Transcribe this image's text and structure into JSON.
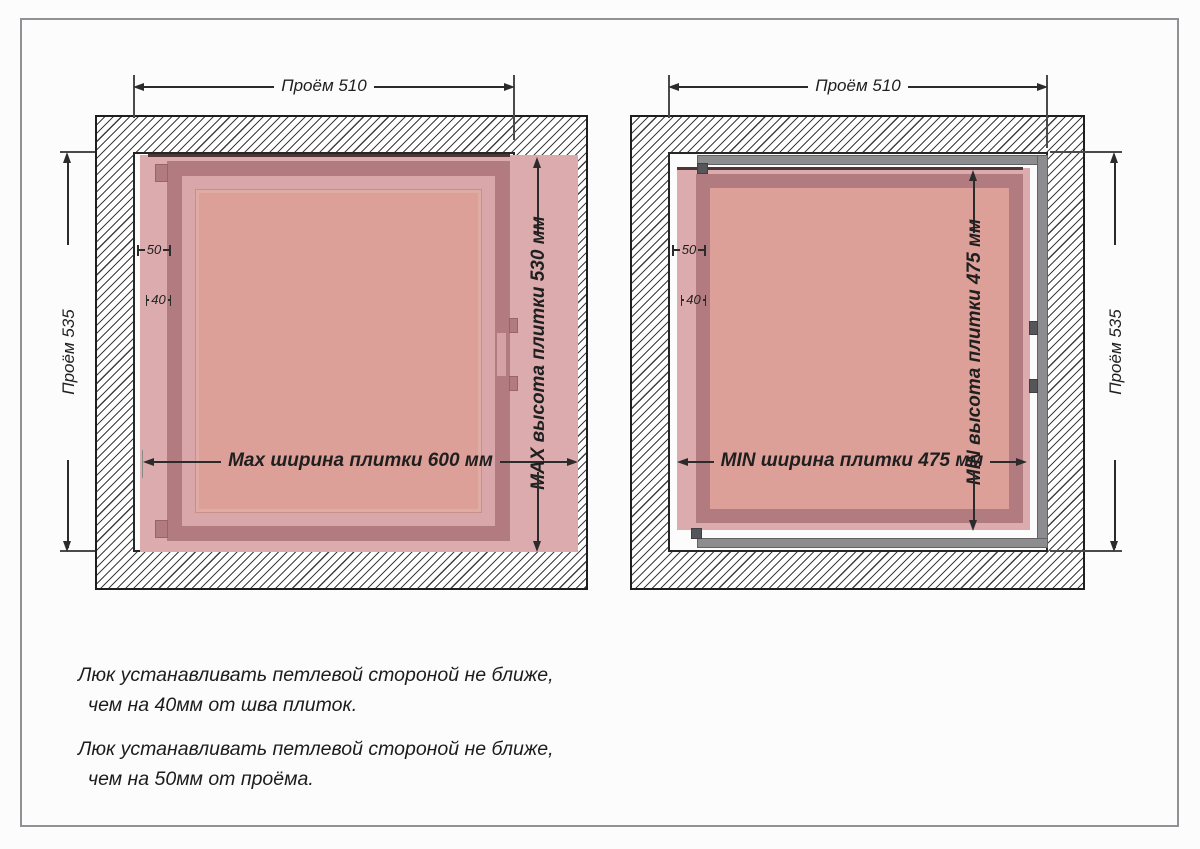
{
  "colors": {
    "tile_pink": "#dcabae",
    "frame_mauve": "#b27b80",
    "panel_salmon": "#dda099",
    "steel_gray": "#8d8d8f",
    "dim_line": "#2b2b2b",
    "dark_edge": "#4e3538"
  },
  "left_diagram": {
    "opening_width": "Проём 510",
    "opening_height": "Проём 535",
    "offset_from_opening": "50",
    "offset_from_seam": "40",
    "tile_width": "Max ширина плитки 600 мм",
    "tile_height": "MAX высота плитки 530 мм"
  },
  "right_diagram": {
    "opening_width": "Проём 510",
    "opening_height": "Проём 535",
    "offset_from_opening": "50",
    "offset_from_seam": "40",
    "tile_width": "MIN ширина плитки 475 мм",
    "tile_height": "MIN высота плитки 475 мм"
  },
  "notes": [
    {
      "line1": "Люк устанавливать петлевой стороной не ближе,",
      "line2": "чем на 40мм от шва плиток."
    },
    {
      "line1": "Люк устанавливать петлевой стороной не ближе,",
      "line2": "чем на 50мм от проёма."
    }
  ]
}
